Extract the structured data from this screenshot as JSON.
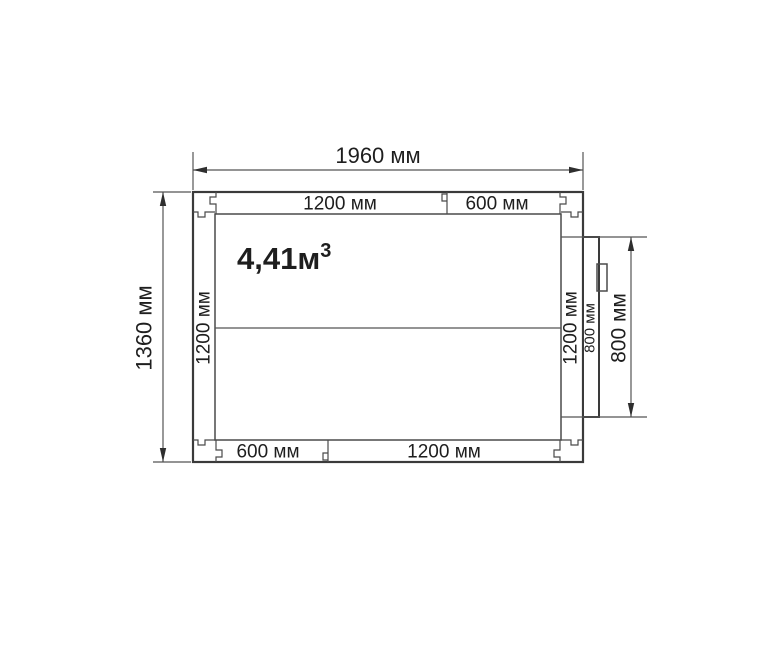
{
  "plan": {
    "volume_label": {
      "main": "4,41м",
      "sup": "3"
    },
    "overall": {
      "width": "1960 мм",
      "height": "1360 мм"
    },
    "door_opening_dim": "800 мм",
    "walls": {
      "top": {
        "panel_a": "1200 мм",
        "panel_b": "600 мм"
      },
      "bottom": {
        "panel_a": "600 мм",
        "panel_b": "1200 мм"
      },
      "left": {
        "panel": "1200 мм"
      },
      "right": {
        "panel": "1200 мм"
      },
      "door": {
        "panel": "800 мм"
      }
    },
    "unit": "мм"
  },
  "style": {
    "background": "#ffffff",
    "line_color": "#3a3a3a",
    "text_color": "#1e1e1e"
  }
}
